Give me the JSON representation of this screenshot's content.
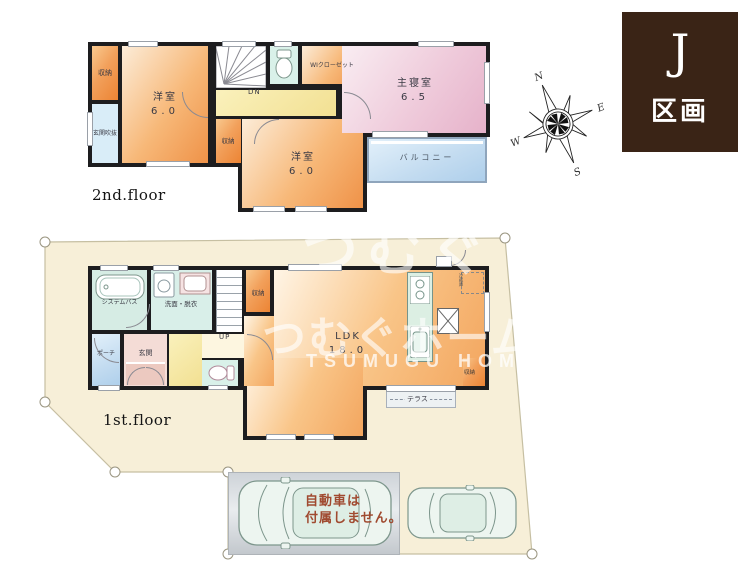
{
  "badge": {
    "letter": "J",
    "label": "区画",
    "bg": "#3a2416"
  },
  "compass": {
    "n": "N",
    "e": "E",
    "s": "S",
    "w": "W"
  },
  "floor2": {
    "caption": "2nd.floor",
    "rooms": {
      "storage1": "収納",
      "void": "玄関吹抜",
      "western1_name": "洋室",
      "western1_size": "6.0",
      "dn": "DN",
      "wic": "WIクローゼット",
      "master_name": "主寝室",
      "master_size": "6.5",
      "balcony": "バルコニー",
      "storage2": "収納",
      "western2_name": "洋室",
      "western2_size": "6.0"
    }
  },
  "floor1": {
    "caption": "1st.floor",
    "rooms": {
      "bath": "システムバス",
      "washroom": "洗面・脱衣",
      "up": "UP",
      "storage1": "収納",
      "ldk_name": "LDK",
      "ldk_size": "18.0",
      "porch": "ポーチ",
      "entrance": "玄関",
      "fridge": "冷蔵庫",
      "storage2": "収納",
      "terrace": "テラス"
    }
  },
  "parking": {
    "note_line1": "自動車は",
    "note_line2": "付属しません。"
  },
  "watermark": {
    "line1": "つむぐ",
    "line2": "つむぐホーム",
    "line3": "TSUMUGU HOME"
  }
}
